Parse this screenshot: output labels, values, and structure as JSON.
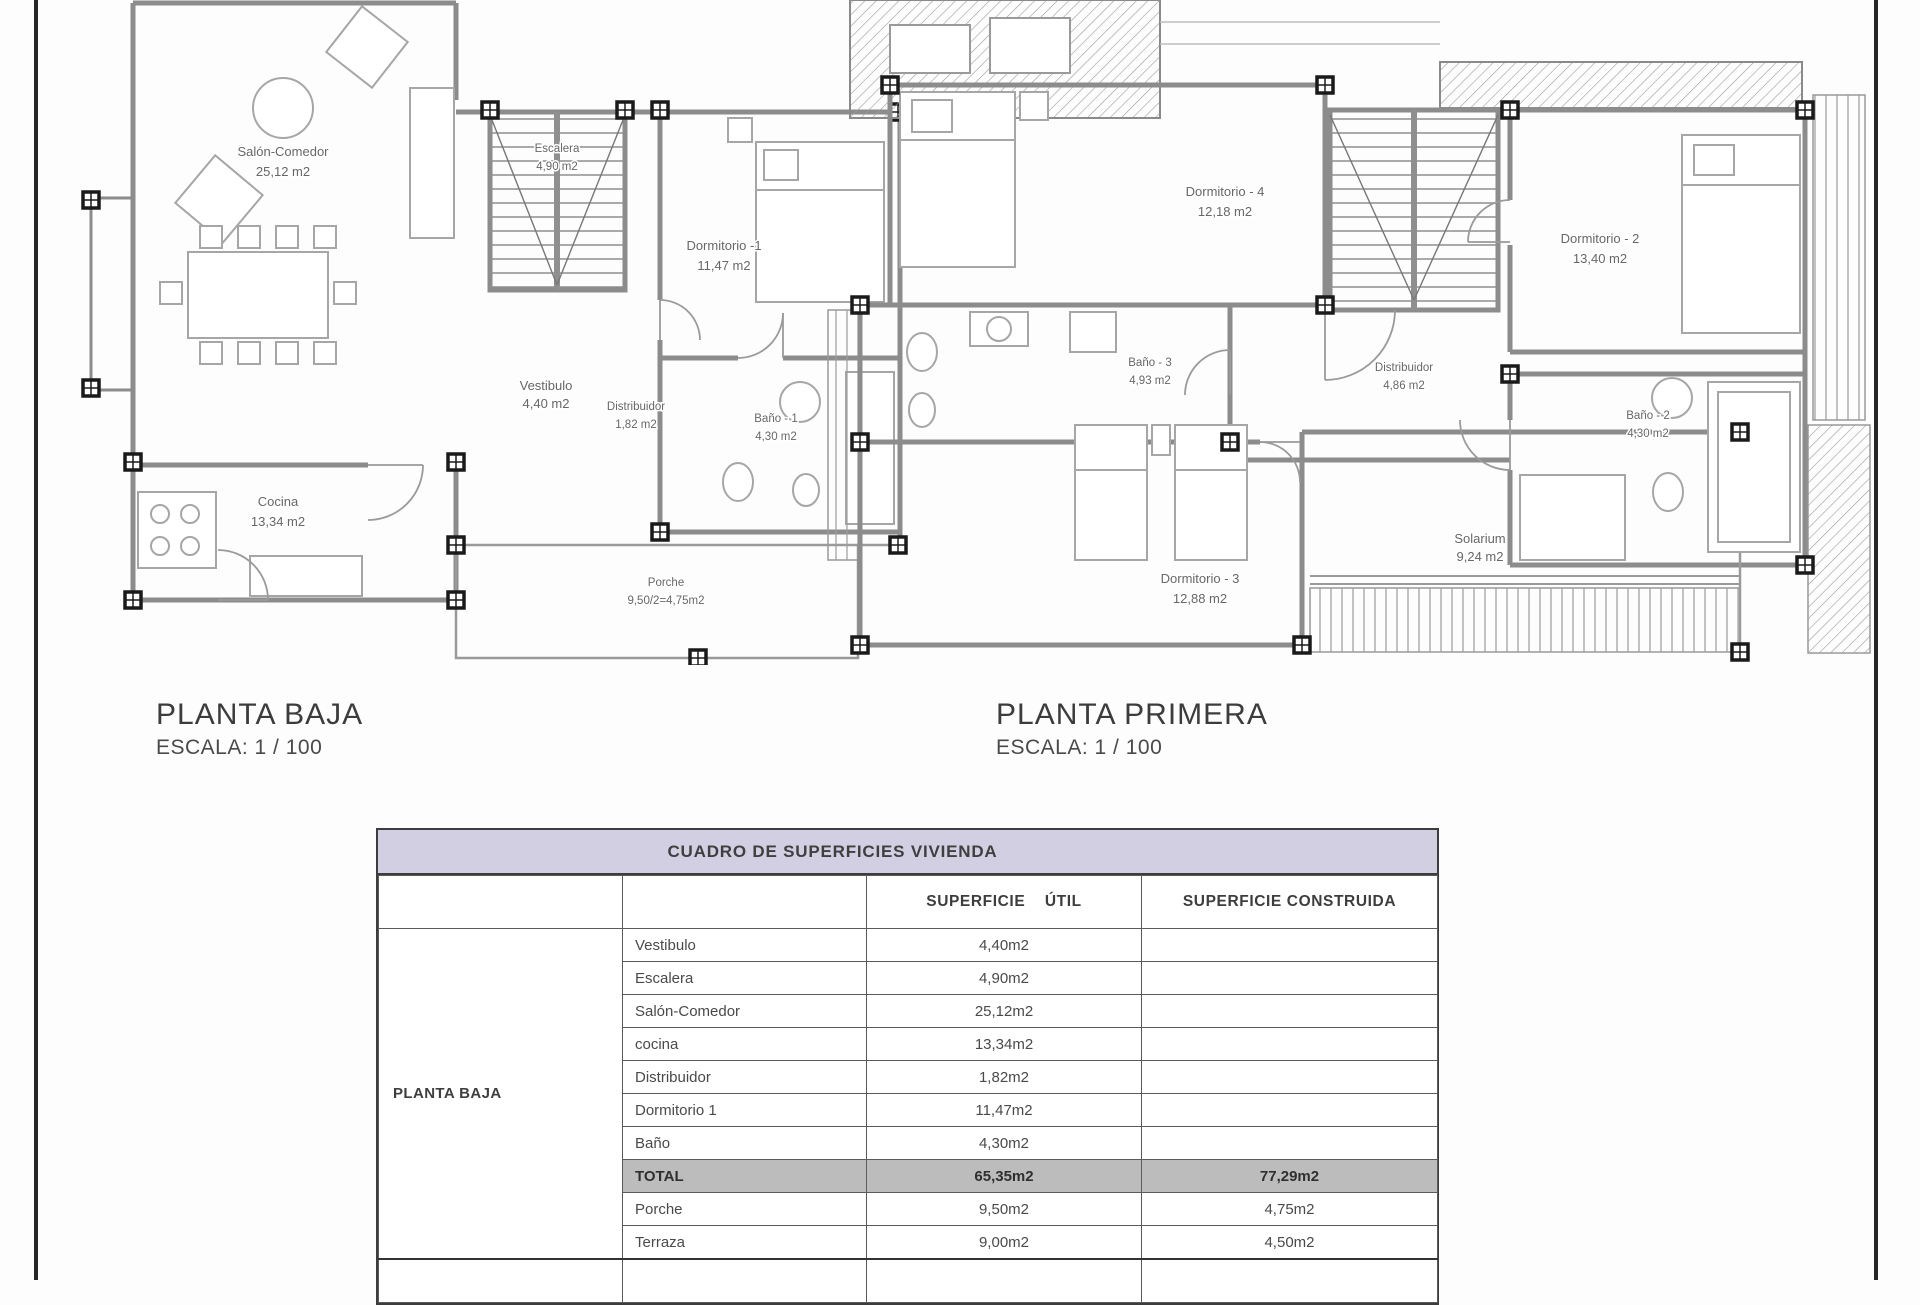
{
  "sheet": {
    "border_color": "#262626"
  },
  "plans": [
    {
      "title": "PLANTA BAJA",
      "scale": "ESCALA: 1 / 100",
      "rooms": [
        {
          "name": "Salón-Comedor",
          "area": "25,12 m2"
        },
        {
          "name": "Escalera",
          "area": "4,90 m2"
        },
        {
          "name": "Dormitorio -1",
          "area": "11,47 m2"
        },
        {
          "name": "Vestibulo",
          "area": "4,40 m2"
        },
        {
          "name": "Distribuidor",
          "area": "1,82 m2"
        },
        {
          "name": "Baño - 1",
          "area": "4,30 m2"
        },
        {
          "name": "Cocina",
          "area": "13,34 m2"
        },
        {
          "name": "Porche",
          "area": "9,50/2=4,75m2"
        }
      ]
    },
    {
      "title": "PLANTA PRIMERA",
      "scale": "ESCALA: 1 / 100",
      "rooms": [
        {
          "name": "Dormitorio - 4",
          "area": "12,18 m2"
        },
        {
          "name": "Dormitorio - 2",
          "area": "13,40 m2"
        },
        {
          "name": "Baño - 3",
          "area": "4,93 m2"
        },
        {
          "name": "Distribuidor",
          "area": "4,86 m2"
        },
        {
          "name": "Baño - 2",
          "area": "4,30 m2"
        },
        {
          "name": "Dormitorio - 3",
          "area": "12,88 m2"
        },
        {
          "name": "Solarium",
          "area": "9,24 m2"
        }
      ]
    }
  ],
  "table": {
    "title": "CUADRO DE SUPERFICIES  VIVIENDA",
    "columns": {
      "util": "SUPERFICIE    ÚTIL",
      "construida": "SUPERFICIE CONSTRUIDA"
    },
    "group_label": "PLANTA BAJA",
    "rows": [
      {
        "label": "Vestibulo",
        "util": "4,40m2",
        "construida": ""
      },
      {
        "label": "Escalera",
        "util": "4,90m2",
        "construida": ""
      },
      {
        "label": "Salón-Comedor",
        "util": "25,12m2",
        "construida": ""
      },
      {
        "label": "cocina",
        "util": "13,34m2",
        "construida": ""
      },
      {
        "label": "Distribuidor",
        "util": "1,82m2",
        "construida": ""
      },
      {
        "label": "Dormitorio 1",
        "util": "11,47m2",
        "construida": ""
      },
      {
        "label": "Baño",
        "util": "4,30m2",
        "construida": ""
      },
      {
        "label": "TOTAL",
        "util": "65,35m2",
        "construida": "77,29m2"
      },
      {
        "label": "Porche",
        "util": "9,50m2",
        "construida": "4,75m2"
      },
      {
        "label": "Terraza",
        "util": "9,00m2",
        "construida": "4,50m2"
      }
    ],
    "colors": {
      "header_bg": "#d3cfe3",
      "total_bg": "#bcbcbc",
      "accent_border": "#3d3d3d"
    }
  }
}
